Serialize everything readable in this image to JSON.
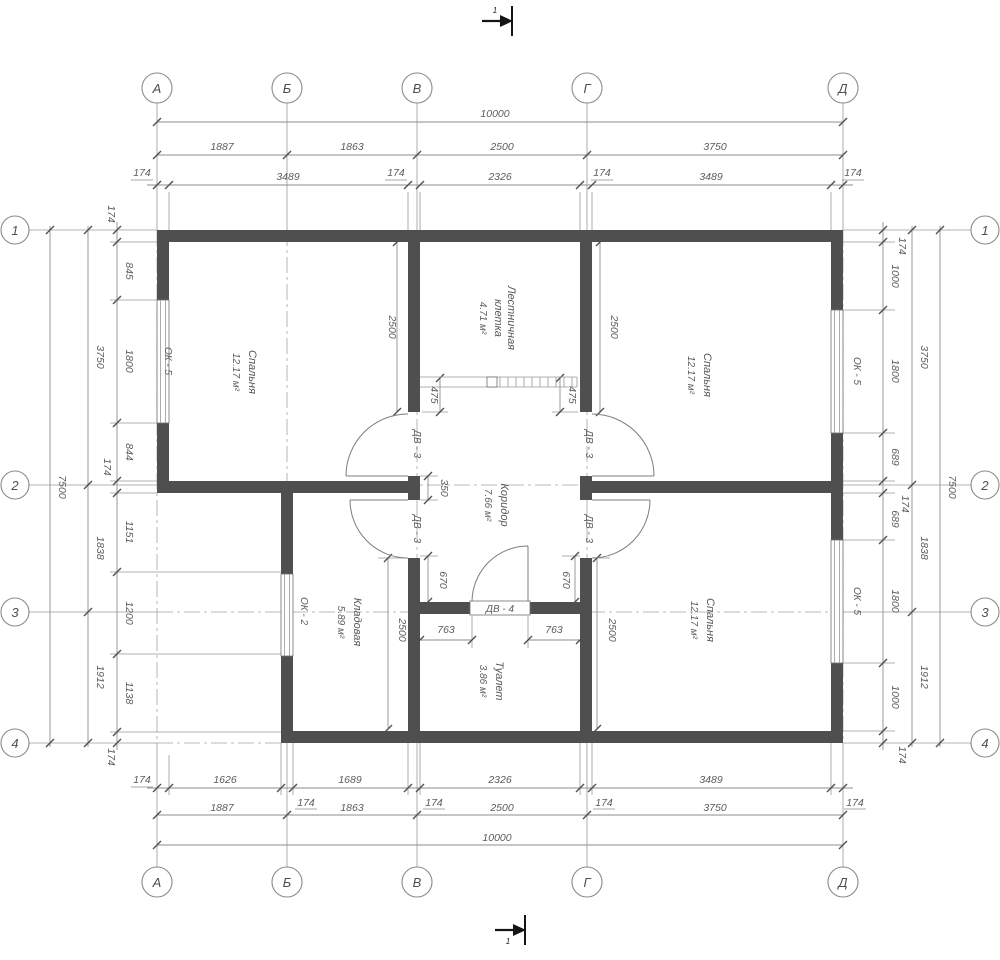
{
  "drawing": {
    "axis_cols": [
      "А",
      "Б",
      "В",
      "Г",
      "Д"
    ],
    "axis_rows": [
      "1",
      "2",
      "3",
      "4"
    ],
    "section_label": "1",
    "rooms": {
      "bedroom_tl": {
        "name": "Спальня",
        "area": "12.17 м²"
      },
      "bedroom_tr": {
        "name": "Спальня",
        "area": "12.17 м²"
      },
      "bedroom_br": {
        "name": "Спальня",
        "area": "12.17 м²"
      },
      "stairwell": {
        "line1": "Лестничная",
        "line2": "клетка",
        "area": "4.71 м²"
      },
      "corridor": {
        "name": "Коридор",
        "area": "7.66 м²"
      },
      "storage": {
        "name": "Кладовая",
        "area": "5.89 м²"
      },
      "toilet": {
        "name": "Туалет",
        "area": "3.86 м²"
      }
    },
    "openings": {
      "window5": "ОК - 5",
      "window2": "ОК - 2",
      "door3": "ДВ - 3",
      "door4": "ДВ - 4"
    },
    "dims": {
      "top1": [
        "174",
        "3489",
        "174",
        "2326",
        "174",
        "3489",
        "174"
      ],
      "top2": [
        "1887",
        "1863",
        "2500",
        "3750"
      ],
      "top3": "10000",
      "bottom1": [
        "174",
        "1626",
        "174",
        "1689",
        "174",
        "2326",
        "174",
        "3489",
        "174"
      ],
      "bottom2": [
        "1887",
        "1863",
        "2500",
        "3750"
      ],
      "bottom3": "10000",
      "left1": [
        "174",
        "845",
        "1800",
        "844",
        "174",
        "1151",
        "1200",
        "1138",
        "174"
      ],
      "left2": [
        "3750",
        "1838",
        "1912"
      ],
      "left3": "7500",
      "right1": [
        "174",
        "1000",
        "1800",
        "689",
        "174",
        "689",
        "1800",
        "1000",
        "174"
      ],
      "right2": [
        "3750",
        "1838",
        "1912"
      ],
      "right3": "7500",
      "stair_width": "2500",
      "stair_offset": "475",
      "stub": "350",
      "door_offset": "670",
      "toilet_offset": "763",
      "room_depth": "2500"
    },
    "colors": {
      "wall": "#4f4f4f",
      "line": "#8e8e8e",
      "text": "#5c5c5c"
    }
  }
}
